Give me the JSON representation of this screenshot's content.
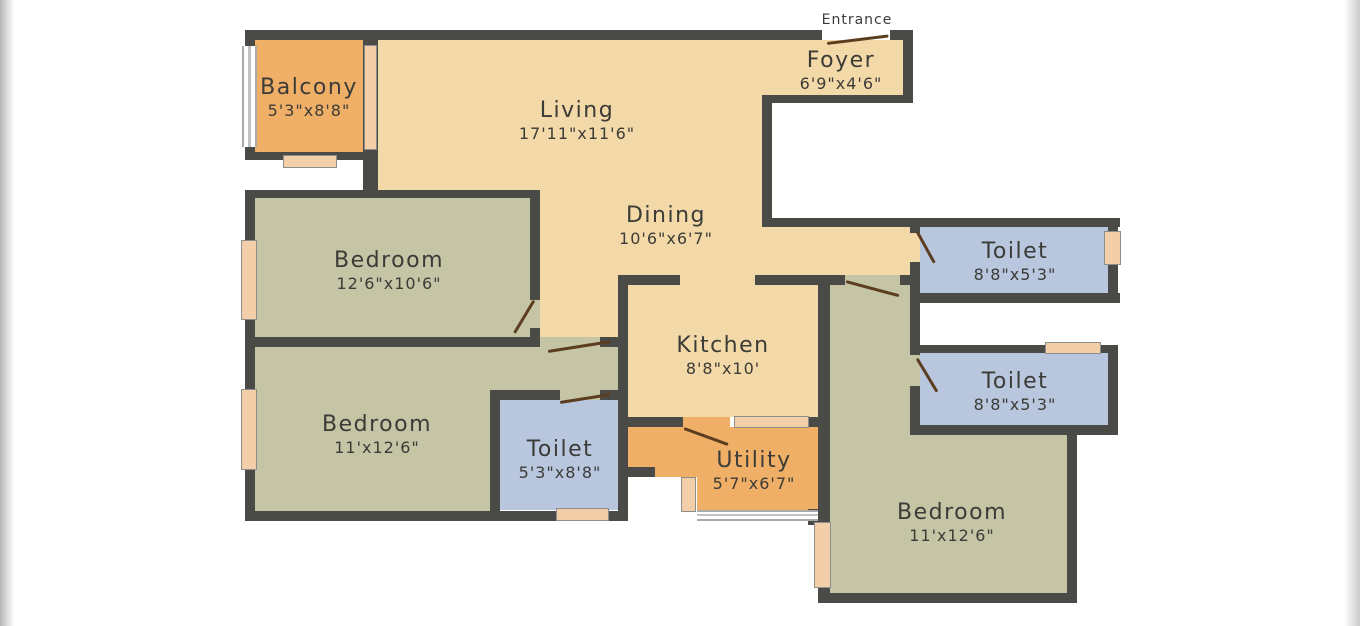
{
  "labels": {
    "entrance": "Entrance"
  },
  "rooms": {
    "balcony": {
      "name": "Balcony",
      "dims": "5'3\"x8'8\""
    },
    "living": {
      "name": "Living",
      "dims": "17'11\"x11'6\""
    },
    "foyer": {
      "name": "Foyer",
      "dims": "6'9\"x4'6\""
    },
    "bedroom1": {
      "name": "Bedroom",
      "dims": "12'6\"x10'6\""
    },
    "dining": {
      "name": "Dining",
      "dims": "10'6\"x6'7\""
    },
    "toilet1": {
      "name": "Toilet",
      "dims": "8'8\"x5'3\""
    },
    "kitchen": {
      "name": "Kitchen",
      "dims": "8'8\"x10'"
    },
    "toilet2": {
      "name": "Toilet",
      "dims": "8'8\"x5'3\""
    },
    "bedroom2": {
      "name": "Bedroom",
      "dims": "11'x12'6\""
    },
    "toilet3": {
      "name": "Toilet",
      "dims": "5'3\"x8'8\""
    },
    "utility": {
      "name": "Utility",
      "dims": "5'7\"x6'7\""
    },
    "bedroom3": {
      "name": "Bedroom",
      "dims": "11'x12'6\""
    }
  },
  "colors": {
    "wall": "#4a4a47",
    "floor_tan": "#f3d9a7",
    "floor_green": "#c5c4a4",
    "floor_blue": "#b9c7de",
    "floor_orange": "#f0af67",
    "window": "#f2cfa9",
    "door": "#5c3d1f",
    "text": "#3b3b37"
  }
}
